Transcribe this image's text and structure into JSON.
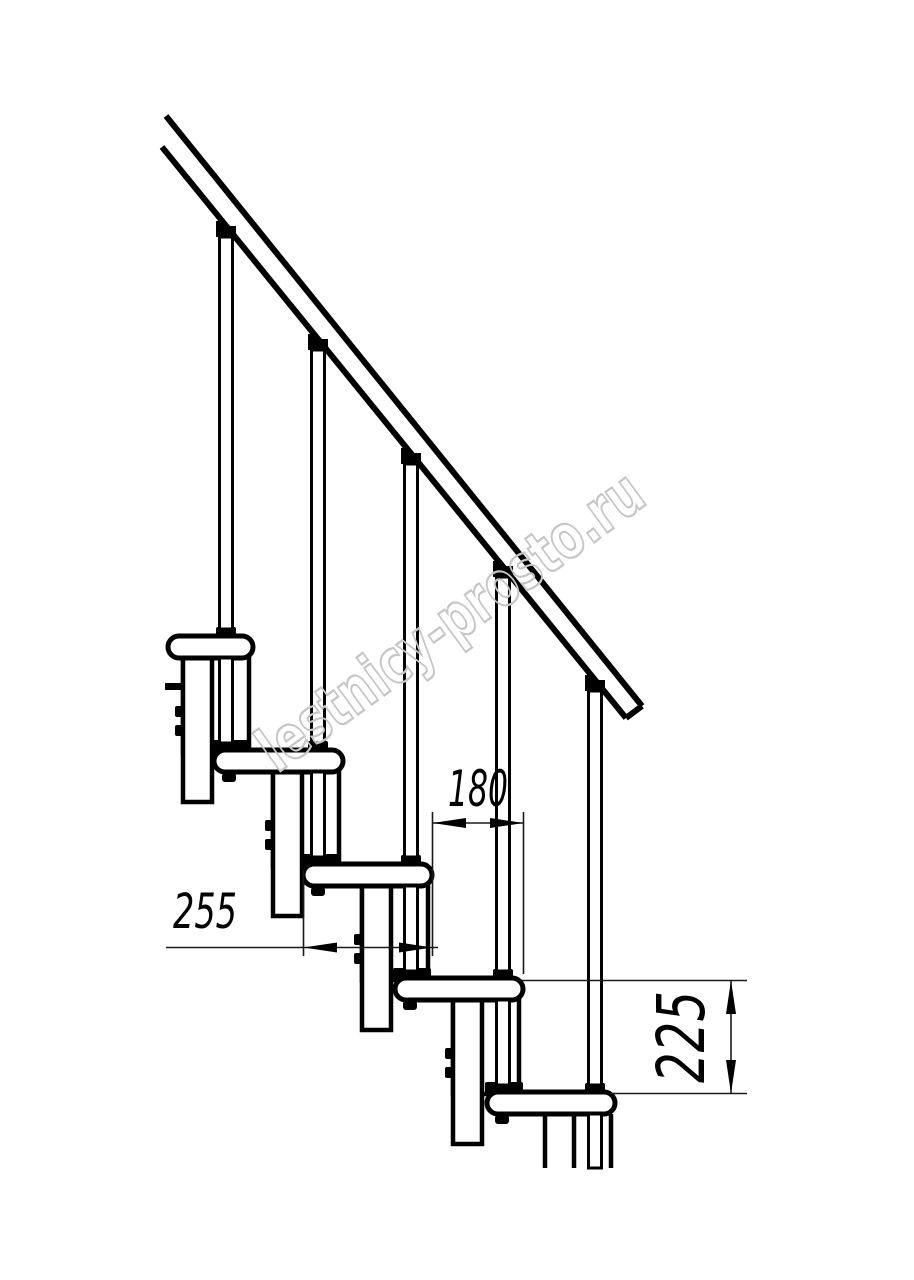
{
  "page": {
    "background": "#ffffff",
    "line_color": "#000000",
    "thin_line_color": "#1a1a1a"
  },
  "watermark": {
    "text": "lestnicy-prosto.ru",
    "color": "#c6c6c6"
  },
  "dimensions": {
    "run": {
      "value": "180"
    },
    "tread_depth": {
      "value": "255"
    },
    "rise": {
      "value": "225"
    }
  }
}
